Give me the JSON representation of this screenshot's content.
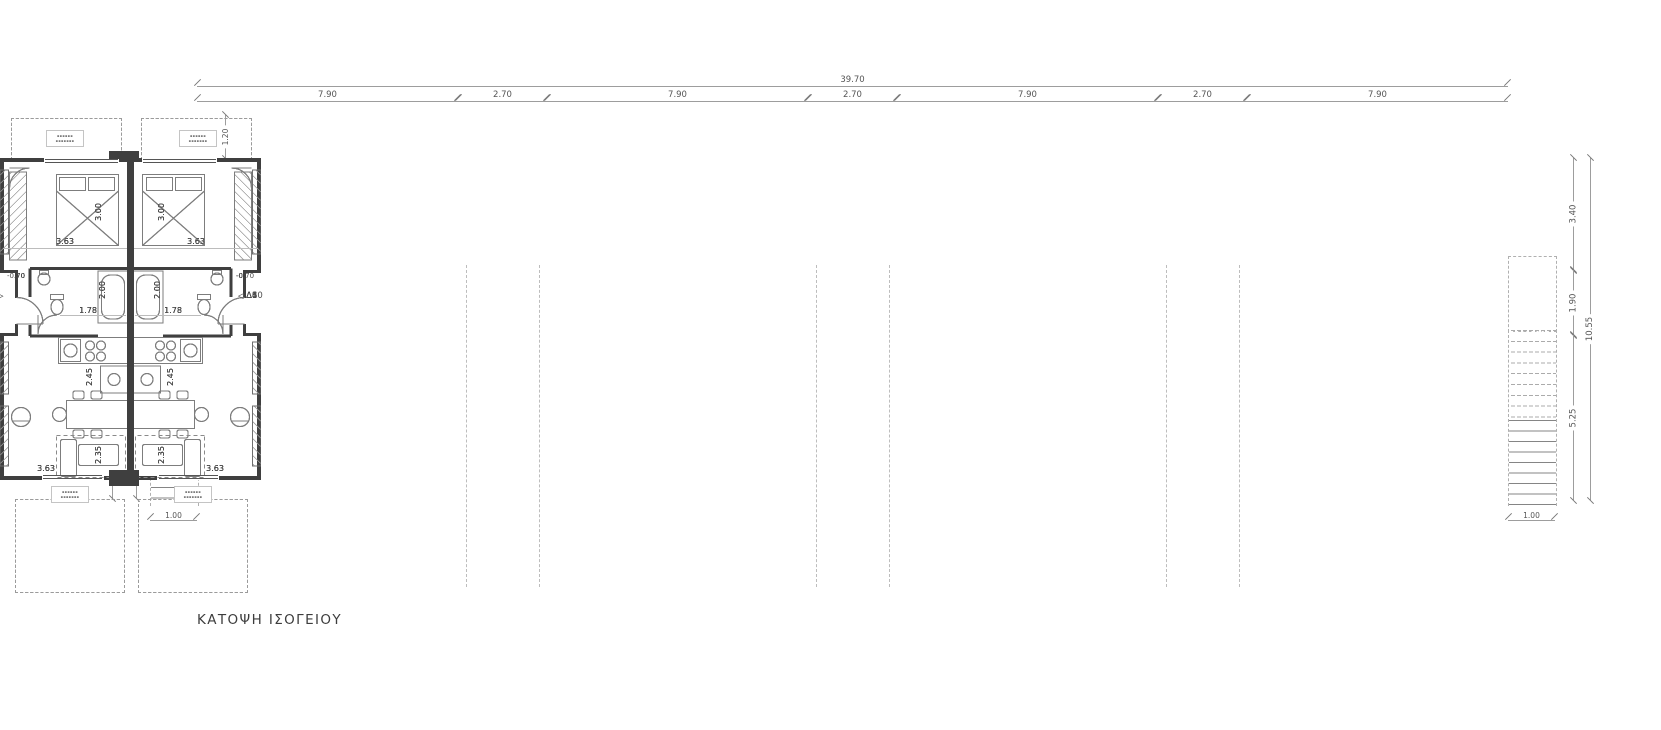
{
  "page": {
    "background": "#ffffff",
    "wall_color": "#3f3f3f",
    "dim_line_color": "#9d9d9d",
    "text_color": "#4a4a4a"
  },
  "title": "ΚΑΤΟΨΗ ΙΣΟΓΕΙΟΥ",
  "dims": {
    "top": {
      "total": "39.70",
      "segments": [
        "7.90",
        "2.70",
        "7.90",
        "2.70",
        "7.90",
        "2.70",
        "7.90"
      ]
    },
    "left": {
      "total": "10.30",
      "segments": [
        "3.40",
        "1.90",
        "5.00"
      ],
      "balcony_depth": "1.20",
      "stair_width": "1.00"
    },
    "right": {
      "total": "10.55",
      "segments": [
        "3.40",
        "1.90",
        "5.25"
      ],
      "stair_width": "1.00"
    }
  },
  "unit": {
    "bedroom_width": "3.63",
    "bed_length": "3.00",
    "bath_depth": "2.00",
    "hall_width": "1.78",
    "kitchen_depth": "2.45",
    "sofa_depth": "2.35",
    "living_width": "3.63",
    "entry_level": "-0.70",
    "window_tag": {
      "line1": "▪▪▪▪▪▪",
      "line2": "▪▪▪▪▪▪▪"
    }
  },
  "buildings": [
    {
      "name": "building-1",
      "units": [
        {
          "door": "Δ3"
        },
        {
          "door": "Δ4"
        }
      ]
    },
    {
      "name": "building-2",
      "units": [
        {
          "door": "Δ5"
        },
        {
          "door": "Δ6"
        }
      ]
    },
    {
      "name": "building-3",
      "units": [
        {
          "door": "Δ7"
        },
        {
          "door": "Δ8"
        }
      ]
    },
    {
      "name": "building-4",
      "units": [
        {
          "door": "Δ9"
        },
        {
          "door": "Δ10"
        }
      ]
    }
  ],
  "stairwells": [
    {
      "name": "stairwell-1"
    },
    {
      "name": "stairwell-2"
    },
    {
      "name": "stairwell-3"
    }
  ]
}
